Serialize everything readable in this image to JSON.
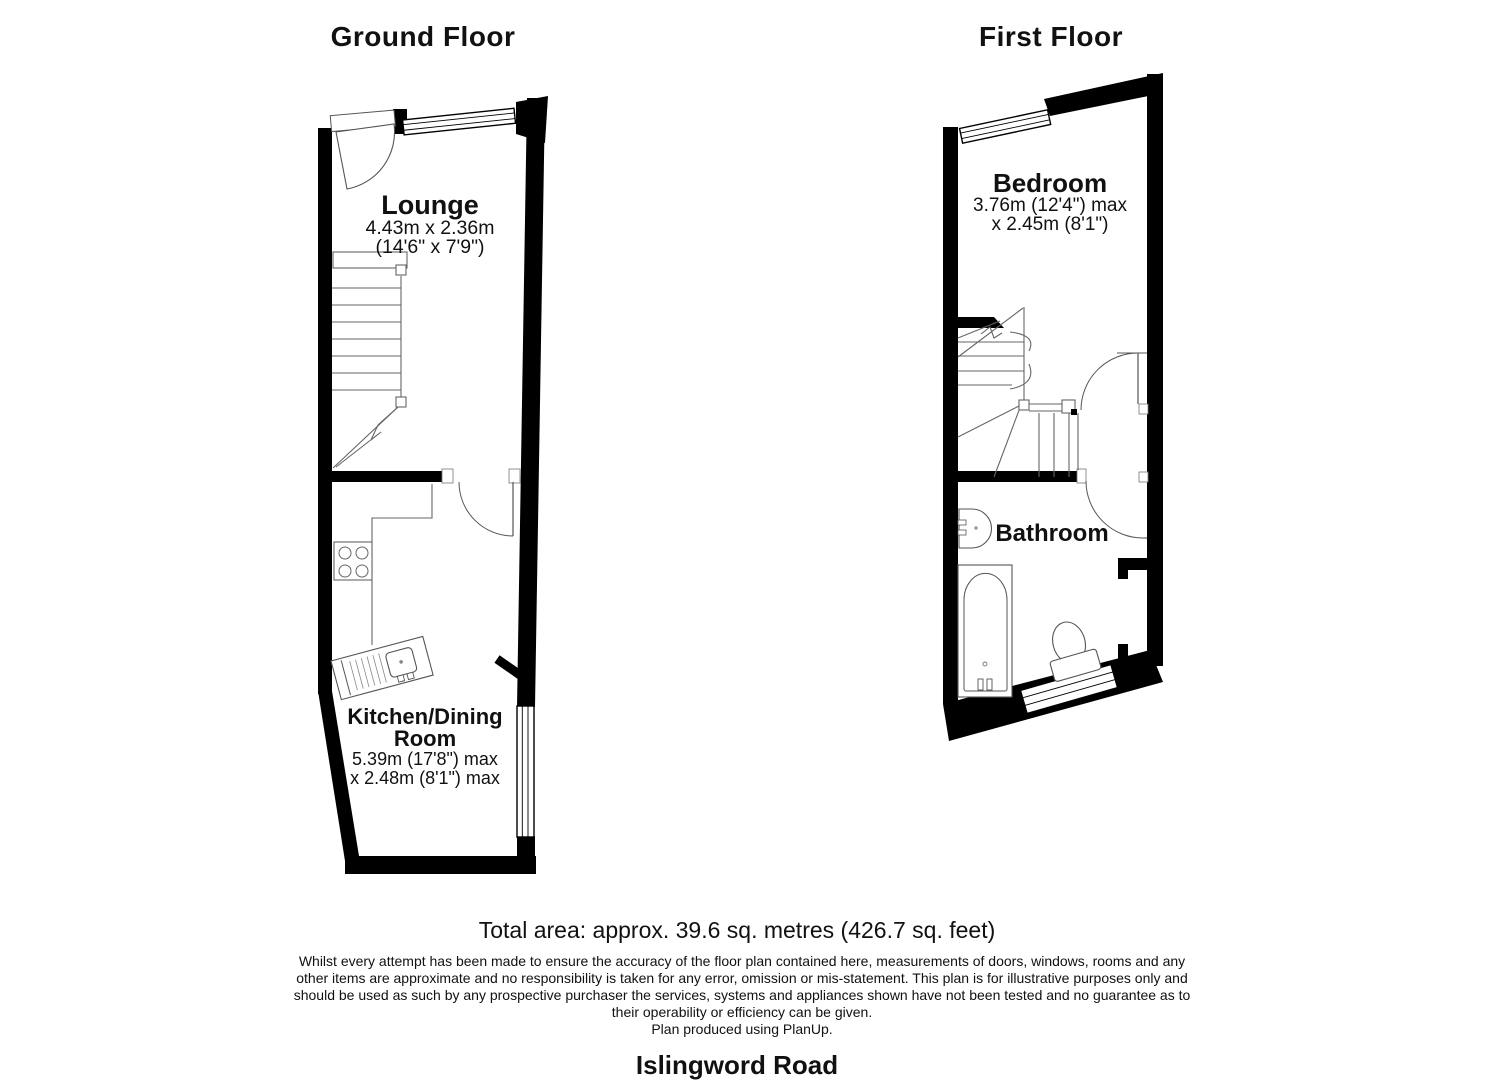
{
  "meta": {
    "background": "#ffffff",
    "wall_color": "#000000",
    "fixture_line_color": "#555555"
  },
  "ground_floor": {
    "title": "Ground Floor",
    "lounge": {
      "name": "Lounge",
      "dim_metric": "4.43m x 2.36m",
      "dim_imperial": "(14'6\" x 7'9\")"
    },
    "kitchen": {
      "name_line1": "Kitchen/Dining",
      "name_line2": "Room",
      "dim_line1": "5.39m (17'8\") max",
      "dim_line2": "x 2.48m (8'1\") max"
    }
  },
  "first_floor": {
    "title": "First Floor",
    "bedroom": {
      "name": "Bedroom",
      "dim_line1": "3.76m (12'4\") max",
      "dim_line2": "x 2.45m (8'1\")"
    },
    "bathroom": {
      "name": "Bathroom"
    }
  },
  "footer": {
    "total_area": "Total area: approx. 39.6 sq. metres (426.7 sq. feet)",
    "disclaimer_lines": [
      "Whilst every attempt has been made to ensure the accuracy of the floor plan contained here, measurements of doors, windows, rooms and any",
      "other items are approximate and no responsibility is taken for any error, omission or mis-statement. This plan is for illustrative purposes only and",
      "should be used as such by any prospective purchaser the services, systems and appliances shown have not been tested and no guarantee as to",
      "their operability or efficiency can be given."
    ],
    "credit": "Plan produced using PlanUp.",
    "address": "Islingword Road"
  }
}
